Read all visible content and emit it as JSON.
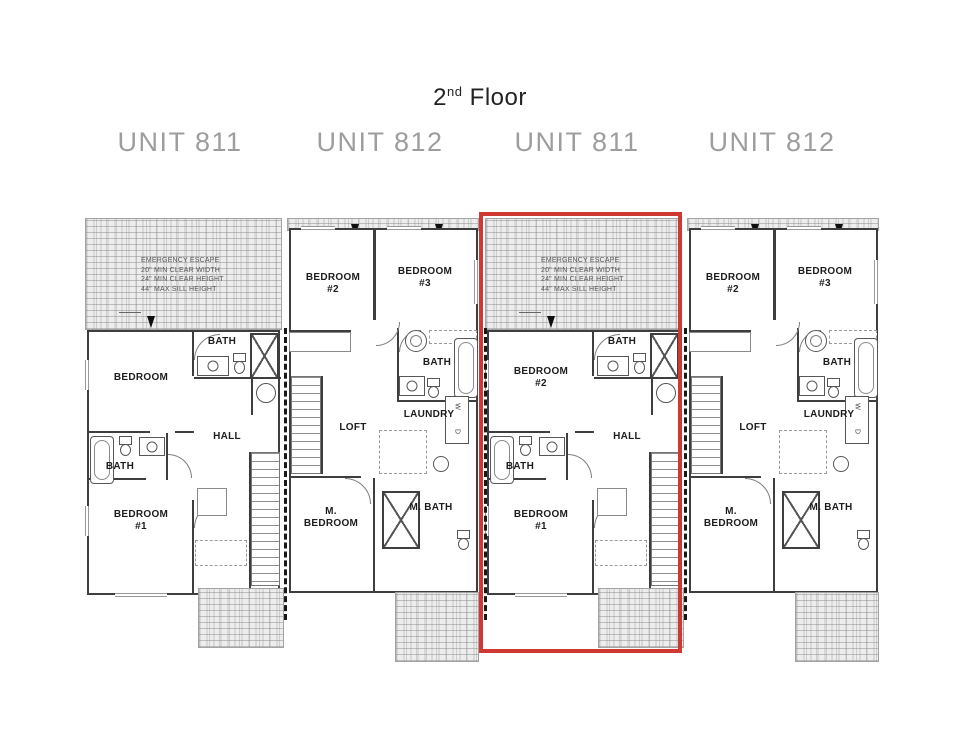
{
  "title": {
    "prefix": "2",
    "ordinal": "nd",
    "suffix": " Floor"
  },
  "unit_labels": [
    {
      "label": "UNIT 811"
    },
    {
      "label": "UNIT 812"
    },
    {
      "label": "UNIT 811"
    },
    {
      "label": "UNIT 812"
    }
  ],
  "emergency_escape": {
    "line1": "EMERGENCY ESCAPE",
    "line2": "20\" MIN CLEAR WIDTH",
    "line3": "24\" MIN CLEAR HEIGHT",
    "line4": "44\" MAX SILL HEIGHT"
  },
  "unit811_a": {
    "bedroom_top": "BEDROOM",
    "bath_top": "BATH",
    "hall": "HALL",
    "bath_mid": "BATH",
    "bedroom1_line1": "BEDROOM",
    "bedroom1_line2": "#1"
  },
  "unit811_b": {
    "bedroom_top_line1": "BEDROOM",
    "bedroom_top_line2": "#2",
    "bath_top": "BATH",
    "hall": "HALL",
    "bath_mid": "BATH",
    "bedroom1_line1": "BEDROOM",
    "bedroom1_line2": "#1"
  },
  "unit812": {
    "bedroom2_line1": "BEDROOM",
    "bedroom2_line2": "#2",
    "bedroom3_line1": "BEDROOM",
    "bedroom3_line2": "#3",
    "bath": "BATH",
    "laundry": "LAUNDRY",
    "washer": "W",
    "dryer": "D",
    "loft": "LOFT",
    "mbedroom_line1": "M.",
    "mbedroom_line2": "BEDROOM",
    "mbath": "M. BATH"
  },
  "highlight": {
    "color": "#ce3a31"
  }
}
